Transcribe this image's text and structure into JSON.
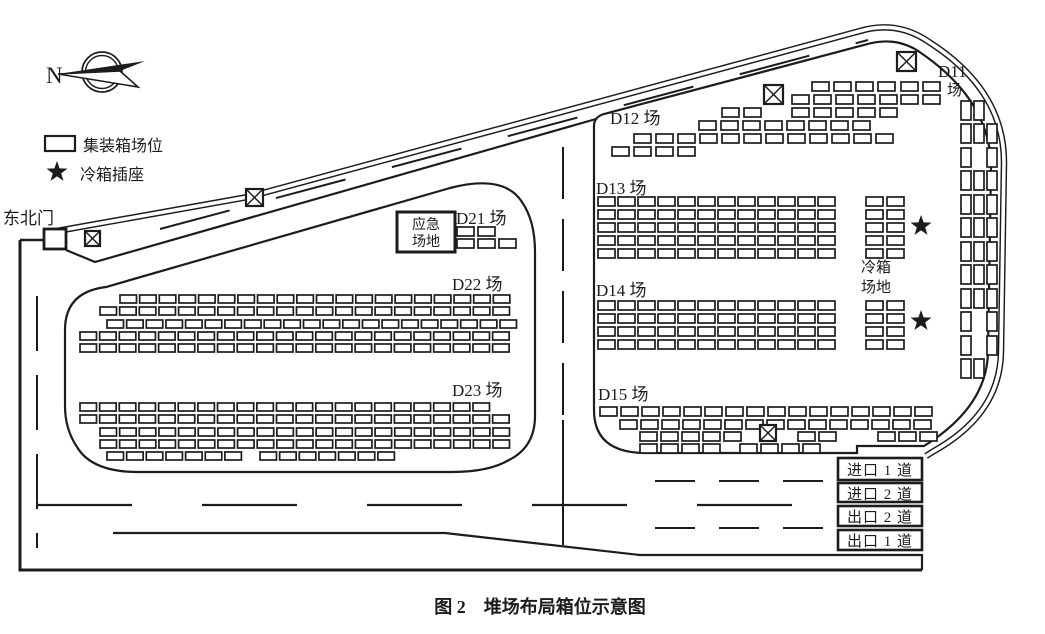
{
  "canvas": {
    "width": 1045,
    "height": 634,
    "background": "#ffffff",
    "line_color": "#1c1c1c"
  },
  "caption": {
    "text": "图 2　堆场布局箱位示意图"
  },
  "compass": {
    "label": "N"
  },
  "legend": {
    "container_label": "集装箱场位",
    "reefer_label": "冷箱插座"
  },
  "gate": {
    "label": "东北门"
  },
  "areas": {
    "d11": {
      "line1": "D11",
      "line2": "场"
    },
    "d12": {
      "label": "D12 场"
    },
    "d13": {
      "label": "D13 场"
    },
    "d14": {
      "label": "D14 场"
    },
    "d15": {
      "label": "D15 场"
    },
    "d21": {
      "label": "D21 场"
    },
    "d22": {
      "label": "D22 场"
    },
    "d23": {
      "label": "D23 场"
    },
    "emergency": {
      "line1": "应急",
      "line2": "场地"
    },
    "reefer_area": {
      "line1": "冷箱",
      "line2": "场地"
    }
  },
  "lanes": [
    {
      "label": "进口 1 道"
    },
    {
      "label": "进口 2 道"
    },
    {
      "label": "出口 2 道"
    },
    {
      "label": "出口 1 道"
    }
  ],
  "symbols": {
    "checkpoints": [
      [
        85,
        231,
        15
      ],
      [
        246,
        189,
        17
      ],
      [
        764,
        85,
        19
      ],
      [
        897,
        52,
        19
      ],
      [
        760,
        425,
        16
      ]
    ],
    "reefer_sockets": [
      [
        921,
        226
      ],
      [
        921,
        321
      ]
    ],
    "legend_star": [
      57,
      172
    ]
  },
  "yard_boxes": [
    {
      "id": "d12",
      "w": 17,
      "h": 9,
      "px": 22,
      "rows": [
        {
          "y": 82,
          "runs": [
            [
              812,
              4
            ],
            [
              901,
              2
            ]
          ]
        },
        {
          "y": 95,
          "runs": [
            [
              792,
              5
            ],
            [
              901,
              2
            ]
          ]
        },
        {
          "y": 108,
          "runs": [
            [
              722,
              2
            ],
            [
              792,
              5
            ]
          ]
        },
        {
          "y": 121,
          "runs": [
            [
              699,
              8
            ]
          ]
        },
        {
          "y": 134,
          "runs": [
            [
              634,
              12
            ]
          ]
        },
        {
          "y": 147,
          "runs": [
            [
              612,
              4
            ]
          ]
        }
      ]
    },
    {
      "id": "d13",
      "w": 17,
      "h": 9,
      "px": 20,
      "rows": [
        {
          "y": 197,
          "runs": [
            [
              598,
              12
            ]
          ]
        },
        {
          "y": 210,
          "runs": [
            [
              598,
              12
            ]
          ]
        },
        {
          "y": 223,
          "runs": [
            [
              598,
              12
            ]
          ]
        },
        {
          "y": 236,
          "runs": [
            [
              598,
              12
            ]
          ]
        },
        {
          "y": 249,
          "runs": [
            [
              598,
              12
            ]
          ]
        }
      ]
    },
    {
      "id": "reefer1",
      "w": 17,
      "h": 9,
      "px": 21,
      "rows": [
        {
          "y": 197,
          "runs": [
            [
              866,
              2
            ]
          ]
        },
        {
          "y": 210,
          "runs": [
            [
              866,
              2
            ]
          ]
        },
        {
          "y": 223,
          "runs": [
            [
              866,
              2
            ]
          ]
        },
        {
          "y": 236,
          "runs": [
            [
              866,
              2
            ]
          ]
        },
        {
          "y": 249,
          "runs": [
            [
              866,
              2
            ]
          ]
        }
      ]
    },
    {
      "id": "d14",
      "w": 17,
      "h": 9,
      "px": 20,
      "rows": [
        {
          "y": 301,
          "runs": [
            [
              598,
              12
            ]
          ]
        },
        {
          "y": 314,
          "runs": [
            [
              598,
              12
            ]
          ]
        },
        {
          "y": 327,
          "runs": [
            [
              598,
              12
            ]
          ]
        },
        {
          "y": 340,
          "runs": [
            [
              598,
              12
            ]
          ]
        }
      ]
    },
    {
      "id": "reefer2",
      "w": 17,
      "h": 9,
      "px": 21,
      "rows": [
        {
          "y": 301,
          "runs": [
            [
              866,
              2
            ]
          ]
        },
        {
          "y": 314,
          "runs": [
            [
              866,
              2
            ]
          ]
        },
        {
          "y": 327,
          "runs": [
            [
              866,
              2
            ]
          ]
        },
        {
          "y": 340,
          "runs": [
            [
              866,
              2
            ]
          ]
        }
      ]
    },
    {
      "id": "d15",
      "w": 17,
      "h": 9,
      "px": 21,
      "rows": [
        {
          "y": 407,
          "runs": [
            [
              600,
              16
            ]
          ]
        },
        {
          "y": 420,
          "runs": [
            [
              620,
              15
            ]
          ]
        },
        {
          "y": 432,
          "runs": [
            [
              640,
              5
            ],
            [
              798,
              2
            ],
            [
              878,
              3
            ]
          ]
        },
        {
          "y": 444,
          "runs": [
            [
              640,
              4
            ],
            [
              740,
              4
            ]
          ]
        }
      ]
    },
    {
      "id": "d21",
      "w": 17,
      "h": 9,
      "px": 21,
      "rows": [
        {
          "y": 227,
          "runs": [
            [
              457,
              2
            ]
          ]
        },
        {
          "y": 239,
          "runs": [
            [
              457,
              3
            ]
          ]
        }
      ]
    },
    {
      "id": "d22",
      "w": 16.5,
      "h": 8,
      "px": 19.65,
      "rows": [
        {
          "y": 295,
          "runs": [
            [
              120,
              20
            ]
          ]
        },
        {
          "y": 307,
          "runs": [
            [
              100,
              21
            ]
          ]
        },
        {
          "y": 320,
          "runs": [
            [
              107,
              21
            ]
          ]
        },
        {
          "y": 332,
          "runs": [
            [
              80,
              22
            ]
          ]
        },
        {
          "y": 344,
          "runs": [
            [
              80,
              22
            ]
          ]
        }
      ]
    },
    {
      "id": "d23",
      "w": 16.5,
      "h": 8,
      "px": 19.65,
      "rows": [
        {
          "y": 403,
          "runs": [
            [
              80,
              21
            ]
          ]
        },
        {
          "y": 415,
          "runs": [
            [
              80,
              22
            ]
          ]
        },
        {
          "y": 428,
          "runs": [
            [
              100,
              21
            ]
          ]
        },
        {
          "y": 440,
          "runs": [
            [
              100,
              21
            ]
          ]
        },
        {
          "y": 452,
          "runs": [
            [
              107,
              7
            ],
            [
              260,
              7
            ]
          ]
        }
      ]
    },
    {
      "id": "d11",
      "w": 10,
      "h": 19,
      "cols": [
        961,
        974,
        987
      ],
      "rows": [
        {
          "y": 101,
          "p": "110"
        },
        {
          "y": 124,
          "p": "111"
        },
        {
          "y": 148,
          "p": "101"
        },
        {
          "y": 171,
          "p": "111"
        },
        {
          "y": 195,
          "p": "111"
        },
        {
          "y": 218,
          "p": "111"
        },
        {
          "y": 242,
          "p": "111"
        },
        {
          "y": 265,
          "p": "111"
        },
        {
          "y": 289,
          "p": "111"
        },
        {
          "y": 312,
          "p": "101"
        },
        {
          "y": 336,
          "p": "101"
        },
        {
          "y": 359,
          "p": "110"
        }
      ]
    }
  ]
}
